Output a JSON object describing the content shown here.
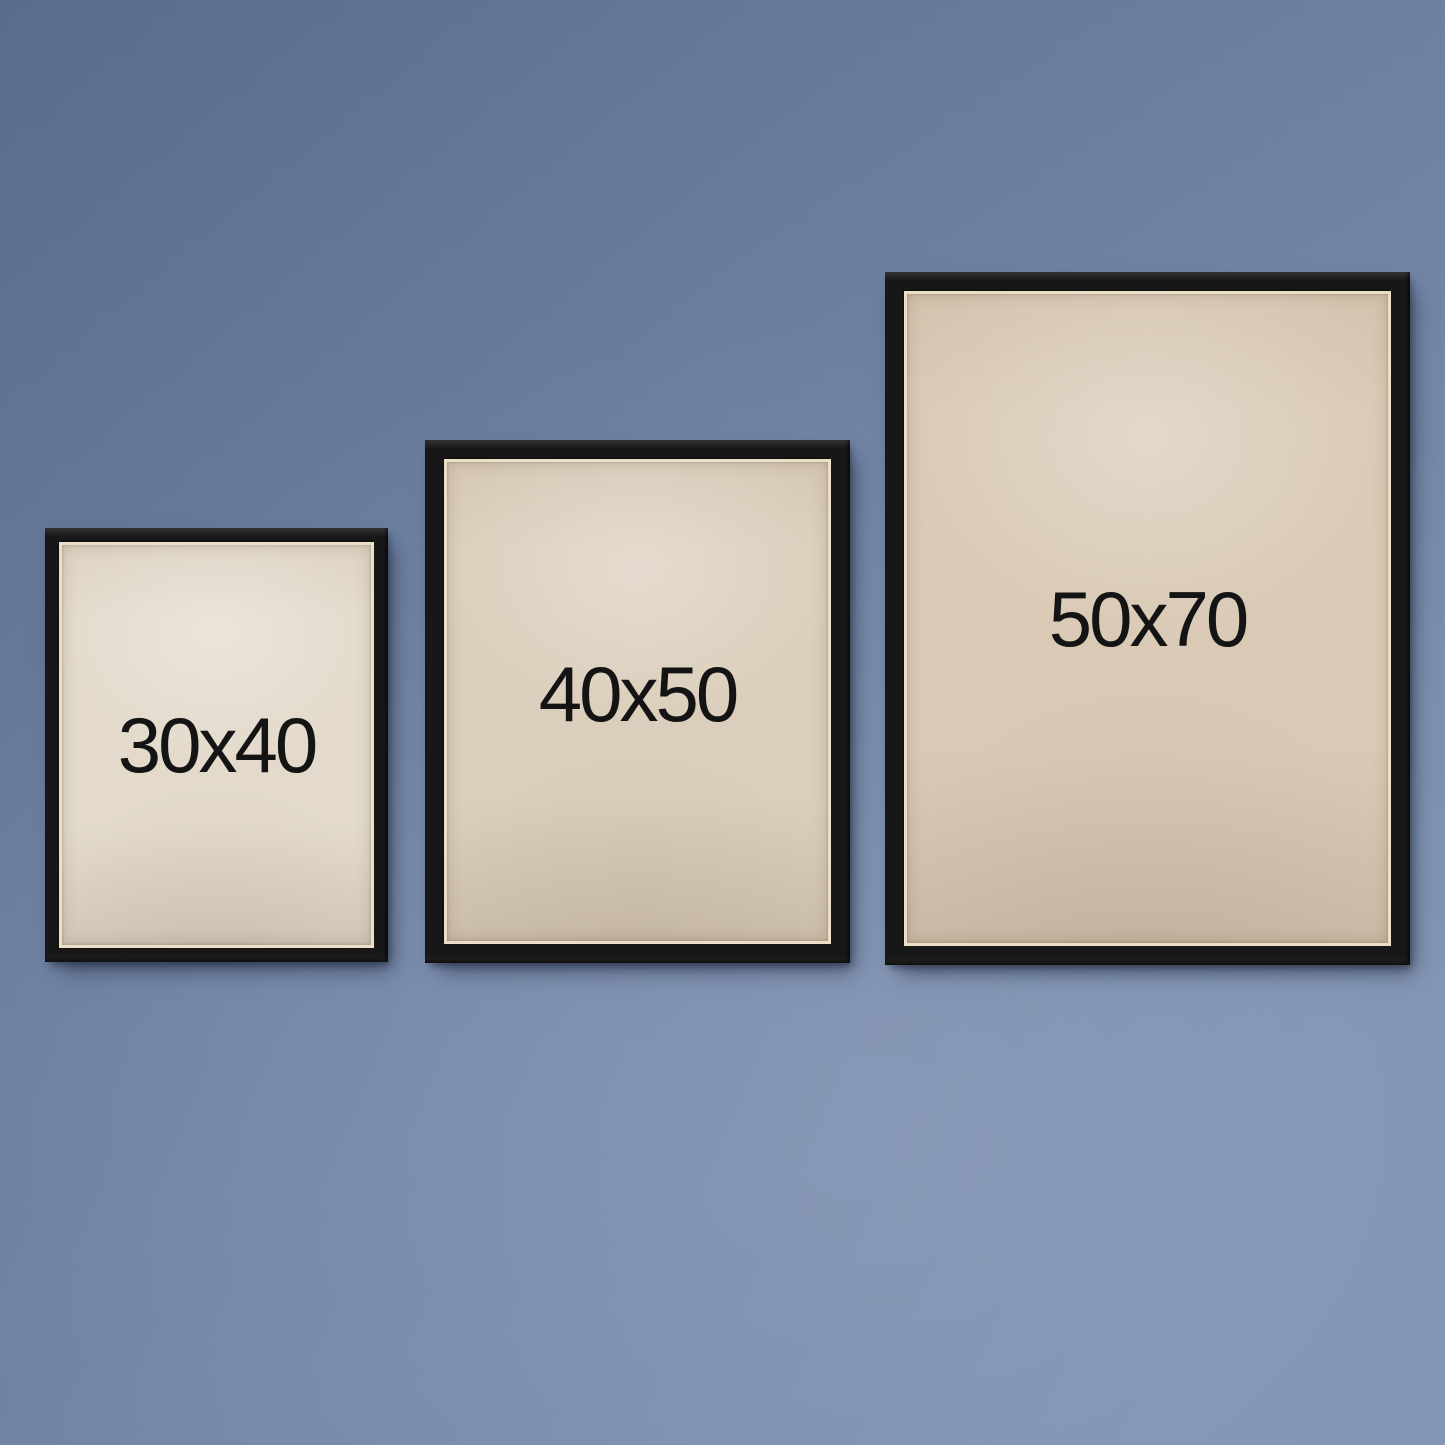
{
  "wall": {
    "color": "#7488ab"
  },
  "label_color": "#141414",
  "frames": [
    {
      "label": "30x40",
      "frame_color": "#171717",
      "paper_color": "#e3dacb"
    },
    {
      "label": "40x50",
      "frame_color": "#171717",
      "paper_color": "#dbcebc"
    },
    {
      "label": "50x70",
      "frame_color": "#171717",
      "paper_color": "#d9c9b5"
    }
  ]
}
